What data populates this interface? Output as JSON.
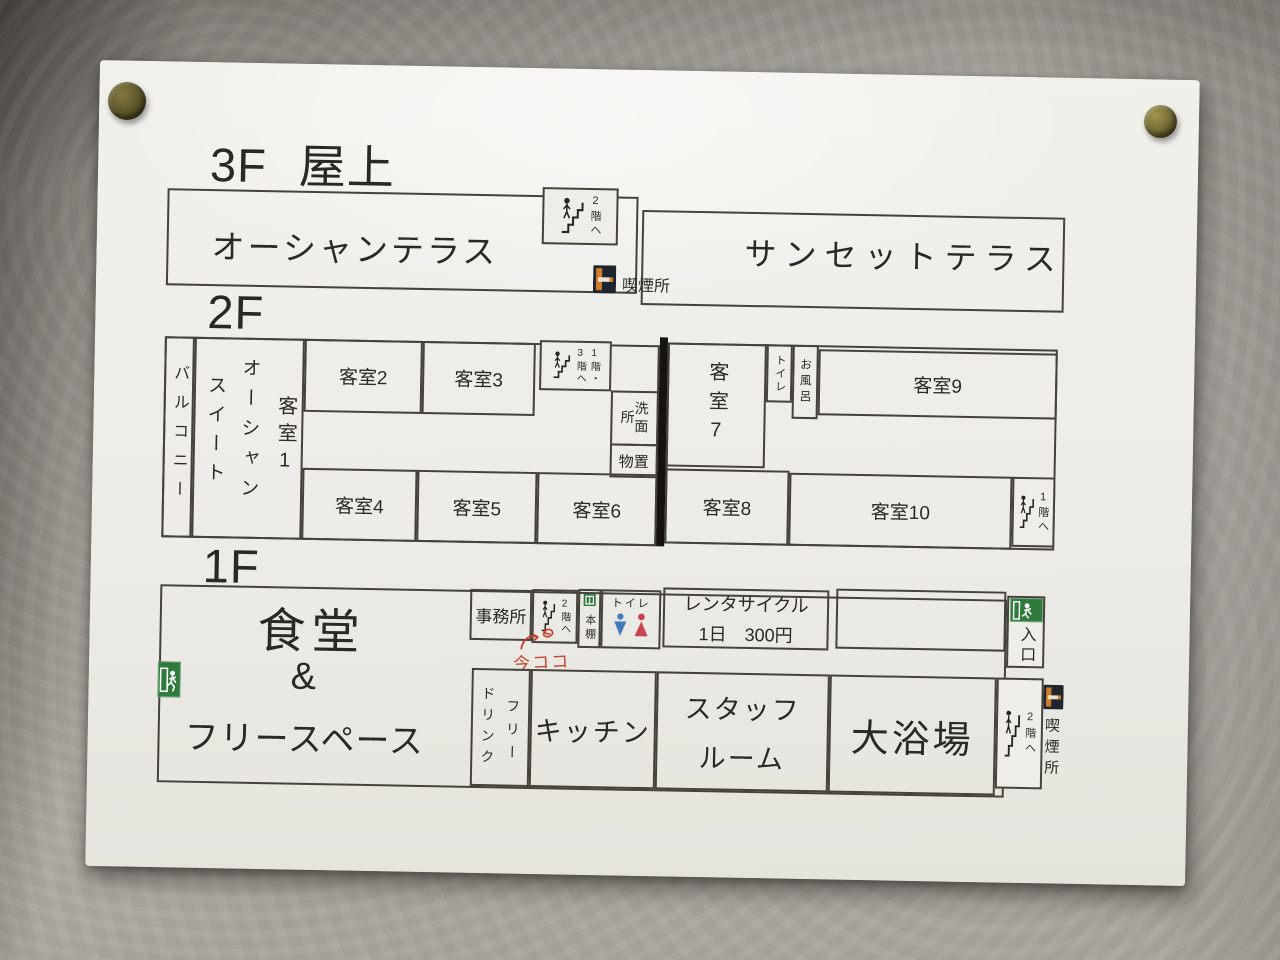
{
  "floor3": {
    "floor_label": "3F",
    "area_label": "屋上",
    "ocean_terrace": "オーシャンテラス",
    "sunset_terrace": "サンセットテラス",
    "stairs_note": "2階へ",
    "smoking_label": "喫煙所"
  },
  "floor2": {
    "floor_label": "2F",
    "balcony": "バルコニー",
    "suite_name_col_left": "スイート",
    "suite_name_col_right": "オーシャン",
    "suite_room": "客室1",
    "room2": "客室2",
    "room3": "客室3",
    "room4": "客室4",
    "room5": "客室5",
    "room6": "客室6",
    "room7": "客室7",
    "room8": "客室8",
    "room9": "客室9",
    "room10": "客室10",
    "stairs_mid_col_left": "3階へ",
    "stairs_mid_col_right": "1階・",
    "washroom": "洗面所",
    "storage": "物置",
    "toilet": "トイレ",
    "bath": "お風呂",
    "stairs_note_right": "1階へ"
  },
  "floor1": {
    "floor_label": "1F",
    "dining": "食堂",
    "ampersand": "&",
    "free_space": "フリースペース",
    "office": "事務所",
    "stairs_note_left": "2階へ",
    "bookshelf": "本棚",
    "toilet": "トイレ",
    "rental_title": "レンタサイクル",
    "rental_price": "1日　300円",
    "entrance": "入口",
    "drink_col_left": "ドリンク",
    "drink_col_right": "フリー",
    "kitchen": "キッチン",
    "staff_room_line1": "スタッフ",
    "staff_room_line2": "ルーム",
    "bath": "大浴場",
    "stairs_note_right": "2階へ",
    "smoking_label": "喫煙所",
    "handwritten_note": "今ココ"
  },
  "colors": {
    "exit_green": "#2f7a3c",
    "toilet_male_blue": "#4479bf",
    "toilet_female_red": "#c84450",
    "smoking_orange": "#cf7d2a",
    "note_red": "#c8402e"
  }
}
